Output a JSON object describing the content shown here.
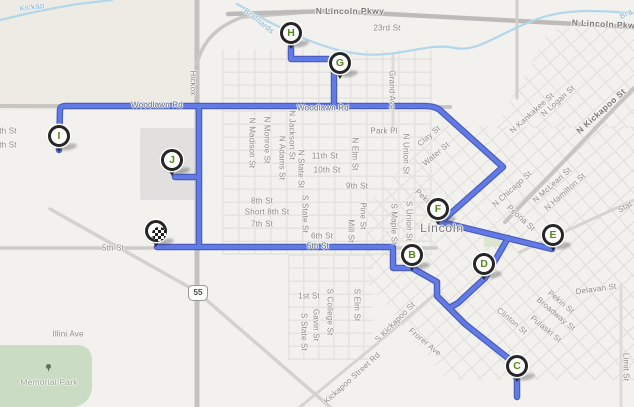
{
  "map": {
    "city_label": "Lincoln",
    "shield": {
      "text": "55"
    },
    "route": {
      "core_color": "#617ae4",
      "casing_color": "#4a5dc0",
      "paths": [
        "M157,247 L393,247 L393,268 L412,268 L437,282 L437,296 L465,324 L513,362 L517,380 L517,397",
        "M449,308 L458,303 L485,278",
        "M485,278 L508,238",
        "M441,222 L552,249",
        "M59,150 L60,110 Q60,106 66,106 L424,106 Q437,106 442,112 L503,167 L441,222",
        "M291,47 L291,59 L334,59 L334,106",
        "M199,106 L199,247",
        "M199,177 L175,177"
      ]
    },
    "markers": [
      {
        "id": "depot",
        "label": "",
        "type": "depot",
        "x": 156,
        "y": 231
      },
      {
        "id": "B",
        "label": "B",
        "type": "stop",
        "x": 412,
        "y": 255
      },
      {
        "id": "C",
        "label": "C",
        "type": "stop",
        "x": 517,
        "y": 366
      },
      {
        "id": "D",
        "label": "D",
        "type": "stop",
        "x": 484,
        "y": 264
      },
      {
        "id": "E",
        "label": "E",
        "type": "stop",
        "x": 553,
        "y": 235
      },
      {
        "id": "F",
        "label": "F",
        "type": "stop",
        "x": 438,
        "y": 209
      },
      {
        "id": "G",
        "label": "G",
        "type": "stop",
        "x": 340,
        "y": 63
      },
      {
        "id": "H",
        "label": "H",
        "type": "stop",
        "x": 291,
        "y": 33
      },
      {
        "id": "I",
        "label": "I",
        "type": "stop",
        "x": 59,
        "y": 136
      },
      {
        "id": "J",
        "label": "J",
        "type": "stop",
        "x": 172,
        "y": 160
      }
    ],
    "roads": [
      {
        "d": "M197,0 L197,407",
        "w": 5,
        "c": "#c3c2c0"
      },
      {
        "d": "M197,64 Q205,30 243,17 L310,12",
        "w": 3.5,
        "c": "#c9c8c6"
      },
      {
        "d": "M228,14 L330,11 L634,27",
        "w": 4.5,
        "c": "#bcbbb9"
      },
      {
        "d": "M0,106 L450,107",
        "w": 4,
        "c": "#c6c5c3"
      },
      {
        "d": "M0,248 L436,248",
        "w": 3.5,
        "c": "#cccbc8"
      },
      {
        "d": "M50,209 L196,291 L330,407",
        "w": 3.5,
        "c": "#d3d2cf"
      },
      {
        "d": "M300,407 L373,347 L434,295",
        "w": 3,
        "c": "#d6d4d1"
      },
      {
        "d": "M634,88 L563,162 L505,222",
        "w": 4,
        "c": "#c6c5c3"
      },
      {
        "d": "M520,252 L634,200",
        "w": 3,
        "c": "#d6d4d1"
      },
      {
        "d": "M621,285 L621,407",
        "w": 3,
        "c": "#dddbd8"
      },
      {
        "d": "M393,55 L393,132",
        "w": 3,
        "c": "#dddbd8"
      },
      {
        "d": "M517,0 L517,98",
        "w": 3,
        "c": "#cfcecb"
      }
    ],
    "water": {
      "color": "#b3d7ea",
      "paths": [
        "M0,20 Q40,10 78,4 L112,0",
        "M237,4 C275,26 320,50 360,54 C400,58 428,42 455,48 C478,53 500,32 540,18 C570,8 600,11 634,13"
      ]
    },
    "areas": [
      {
        "name": "terrain-wash",
        "x": 0,
        "y": 0,
        "w": 196,
        "h": 110,
        "fill": "#edebe4",
        "radius": "0"
      },
      {
        "name": "industrial-parcel",
        "x": 140,
        "y": 128,
        "w": 58,
        "h": 72,
        "fill": "#e1e0de",
        "radius": "2px"
      },
      {
        "name": "memorial-park-area",
        "x": 0,
        "y": 345,
        "w": 92,
        "h": 62,
        "fill": "#cbdcc5",
        "radius": "0 14px 20px 0"
      },
      {
        "name": "green-block",
        "x": 484,
        "y": 231,
        "w": 17,
        "h": 16,
        "fill": "#d9e7cf",
        "radius": "2px"
      }
    ],
    "labels": [
      {
        "t": "N Lincoln Pkwy",
        "x": 350,
        "y": 11,
        "r": 0,
        "c": "major"
      },
      {
        "t": "N Lincoln Pkwy",
        "x": 606,
        "y": 24,
        "r": 3,
        "c": "major"
      },
      {
        "t": "23rd St",
        "x": 387,
        "y": 28,
        "r": 0,
        "c": ""
      },
      {
        "t": "Woodlawn Rd",
        "x": 157,
        "y": 105,
        "r": 0,
        "c": "onroute"
      },
      {
        "t": "Woodlawn Rd",
        "x": 323,
        "y": 108,
        "r": 0,
        "c": "onroute"
      },
      {
        "t": "Park Pl",
        "x": 384,
        "y": 131,
        "r": 0,
        "c": ""
      },
      {
        "t": "11th St",
        "x": 325,
        "y": 156,
        "r": 0,
        "c": ""
      },
      {
        "t": "10th St",
        "x": 327,
        "y": 170,
        "r": 0,
        "c": ""
      },
      {
        "t": "9th St",
        "x": 357,
        "y": 186,
        "r": 0,
        "c": ""
      },
      {
        "t": "8th St",
        "x": 262,
        "y": 201,
        "r": 0,
        "c": ""
      },
      {
        "t": "Short 8th St",
        "x": 267,
        "y": 212,
        "r": 0,
        "c": ""
      },
      {
        "t": "7th St",
        "x": 262,
        "y": 224,
        "r": 0,
        "c": ""
      },
      {
        "t": "6th St",
        "x": 322,
        "y": 236,
        "r": 0,
        "c": ""
      },
      {
        "t": "5th St",
        "x": 113,
        "y": 248,
        "r": 0,
        "c": ""
      },
      {
        "t": "5th St",
        "x": 318,
        "y": 246,
        "r": 0,
        "c": "onroute"
      },
      {
        "t": "1st St",
        "x": 309,
        "y": 296,
        "r": 0,
        "c": ""
      },
      {
        "t": "Illini Ave",
        "x": 68,
        "y": 334,
        "r": 0,
        "c": ""
      },
      {
        "t": "Memorial Park",
        "x": 49,
        "y": 382,
        "r": 0,
        "c": "park"
      },
      {
        "t": "Delavan St",
        "x": 596,
        "y": 289,
        "r": -8,
        "c": ""
      },
      {
        "t": "Lincoln",
        "x": 442,
        "y": 228,
        "r": 0,
        "c": "city"
      },
      {
        "t": "Hickox",
        "x": 193,
        "y": 83,
        "r": 90,
        "c": ""
      },
      {
        "t": "N Madison St",
        "x": 252,
        "y": 143,
        "r": 90,
        "c": ""
      },
      {
        "t": "N Monroe St",
        "x": 267,
        "y": 140,
        "r": 90,
        "c": ""
      },
      {
        "t": "N Adams St",
        "x": 282,
        "y": 158,
        "r": 90,
        "c": ""
      },
      {
        "t": "N Jackson St",
        "x": 292,
        "y": 135,
        "r": 90,
        "c": ""
      },
      {
        "t": "N State St",
        "x": 301,
        "y": 169,
        "r": 90,
        "c": ""
      },
      {
        "t": "S State St",
        "x": 305,
        "y": 214,
        "r": 90,
        "c": ""
      },
      {
        "t": "N Elm St",
        "x": 355,
        "y": 154,
        "r": 90,
        "c": ""
      },
      {
        "t": "Pine St",
        "x": 363,
        "y": 216,
        "r": 90,
        "c": ""
      },
      {
        "t": "Mill St",
        "x": 351,
        "y": 231,
        "r": 90,
        "c": ""
      },
      {
        "t": "S Maple St",
        "x": 394,
        "y": 224,
        "r": 90,
        "c": ""
      },
      {
        "t": "S Union St",
        "x": 409,
        "y": 221,
        "r": 90,
        "c": ""
      },
      {
        "t": "N Union St",
        "x": 406,
        "y": 154,
        "r": 90,
        "c": ""
      },
      {
        "t": "Grand Ave",
        "x": 392,
        "y": 90,
        "r": 90,
        "c": ""
      },
      {
        "t": "S College St",
        "x": 330,
        "y": 312,
        "r": 90,
        "c": ""
      },
      {
        "t": "Gavin St",
        "x": 316,
        "y": 325,
        "r": 90,
        "c": ""
      },
      {
        "t": "S State St",
        "x": 304,
        "y": 332,
        "r": 90,
        "c": ""
      },
      {
        "t": "S Elm St",
        "x": 357,
        "y": 305,
        "r": 90,
        "c": ""
      },
      {
        "t": "Limit St",
        "x": 626,
        "y": 367,
        "r": 90,
        "c": ""
      },
      {
        "t": "th St",
        "x": 8,
        "y": 131,
        "r": 0,
        "c": ""
      },
      {
        "t": "th St",
        "x": 8,
        "y": 145,
        "r": 0,
        "c": ""
      },
      {
        "t": "N Kankakee St",
        "x": 532,
        "y": 113,
        "r": -42,
        "c": ""
      },
      {
        "t": "N Logan St",
        "x": 558,
        "y": 101,
        "r": -42,
        "c": ""
      },
      {
        "t": "N Kickapoo St",
        "x": 601,
        "y": 111,
        "r": -42,
        "c": "major"
      },
      {
        "t": "Clay St",
        "x": 429,
        "y": 136,
        "r": -40,
        "c": ""
      },
      {
        "t": "Water St",
        "x": 436,
        "y": 154,
        "r": -40,
        "c": ""
      },
      {
        "t": "N Chicago St",
        "x": 512,
        "y": 189,
        "r": -42,
        "c": ""
      },
      {
        "t": "N McLean St",
        "x": 552,
        "y": 185,
        "r": -42,
        "c": ""
      },
      {
        "t": "N Hamilton St",
        "x": 565,
        "y": 192,
        "r": -42,
        "c": ""
      },
      {
        "t": "S Kickapoo St",
        "x": 395,
        "y": 322,
        "r": -45,
        "c": ""
      },
      {
        "t": "Kickapoo Street Rd",
        "x": 352,
        "y": 378,
        "r": -42,
        "c": ""
      },
      {
        "t": "Stat",
        "x": 625,
        "y": 207,
        "r": -30,
        "c": ""
      },
      {
        "t": "Brainards",
        "x": 259,
        "y": 21,
        "r": 38,
        "c": "water"
      },
      {
        "t": "Kickap",
        "x": 32,
        "y": 7,
        "r": -8,
        "c": "water"
      },
      {
        "t": "Bra",
        "x": 626,
        "y": 14,
        "r": -25,
        "c": "water"
      },
      {
        "t": "Pekin St",
        "x": 561,
        "y": 302,
        "r": 40,
        "c": ""
      },
      {
        "t": "Broadway St",
        "x": 556,
        "y": 314,
        "r": 40,
        "c": ""
      },
      {
        "t": "Pulaski St",
        "x": 546,
        "y": 329,
        "r": 40,
        "c": ""
      },
      {
        "t": "Clinton St",
        "x": 512,
        "y": 321,
        "r": 40,
        "c": ""
      },
      {
        "t": "Peoria St",
        "x": 521,
        "y": 218,
        "r": 42,
        "c": ""
      },
      {
        "t": "Frorer Ave",
        "x": 425,
        "y": 342,
        "r": 40,
        "c": ""
      },
      {
        "t": "Pekin St",
        "x": 428,
        "y": 201,
        "r": 42,
        "c": ""
      }
    ]
  }
}
